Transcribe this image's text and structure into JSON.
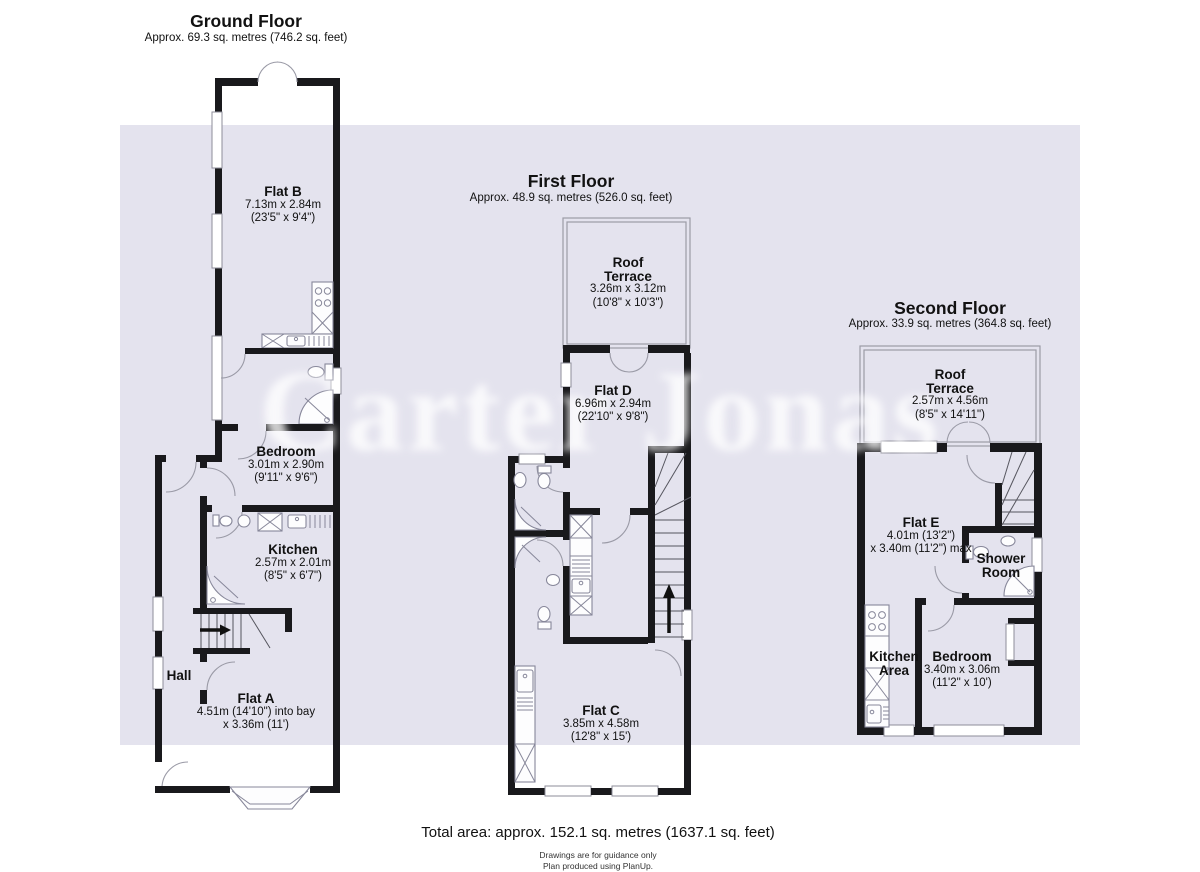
{
  "watermark": "Carter Jonas",
  "colors": {
    "band": "#e4e3ee",
    "wall": "#19191c"
  },
  "floors": [
    {
      "title": "Ground Floor",
      "subtitle": "Approx. 69.3 sq. metres (746.2 sq. feet)",
      "rooms": [
        {
          "name": "Flat B",
          "dim1": "7.13m x 2.84m",
          "dim2": "(23'5\" x 9'4\")"
        },
        {
          "name": "Bedroom",
          "dim1": "3.01m x 2.90m",
          "dim2": "(9'11\" x 9'6\")"
        },
        {
          "name": "Kitchen",
          "dim1": "2.57m x 2.01m",
          "dim2": "(8'5\" x 6'7\")"
        },
        {
          "name": "Hall"
        },
        {
          "name": "Flat A",
          "dim1": "4.51m (14'10\") into bay",
          "dim2": "x 3.36m (11')"
        }
      ]
    },
    {
      "title": "First Floor",
      "subtitle": "Approx. 48.9 sq. metres (526.0 sq. feet)",
      "rooms": [
        {
          "name": "Roof",
          "name2": "Terrace",
          "dim1": "3.26m x 3.12m",
          "dim2": "(10'8\" x 10'3\")"
        },
        {
          "name": "Flat D",
          "dim1": "6.96m x 2.94m",
          "dim2": "(22'10\" x 9'8\")"
        },
        {
          "name": "Flat C",
          "dim1": "3.85m x 4.58m",
          "dim2": "(12'8\" x 15')"
        }
      ]
    },
    {
      "title": "Second Floor",
      "subtitle": "Approx. 33.9 sq. metres (364.8 sq. feet)",
      "rooms": [
        {
          "name": "Roof",
          "name2": "Terrace",
          "dim1": "2.57m x 4.56m",
          "dim2": "(8'5\" x 14'11\")"
        },
        {
          "name": "Flat E",
          "dim1": "4.01m (13'2\")",
          "dim2": "x 3.40m (11'2\") max"
        },
        {
          "name": "Shower",
          "name2": "Room"
        },
        {
          "name": "Kitchen",
          "name2": "Area"
        },
        {
          "name": "Bedroom",
          "dim1": "3.40m x 3.06m",
          "dim2": "(11'2\" x 10')"
        }
      ]
    }
  ],
  "footer": {
    "total": "Total area: approx. 152.1 sq. metres (1637.1 sq. feet)",
    "note1": "Drawings are for guidance only",
    "note2": "Plan produced using PlanUp."
  }
}
